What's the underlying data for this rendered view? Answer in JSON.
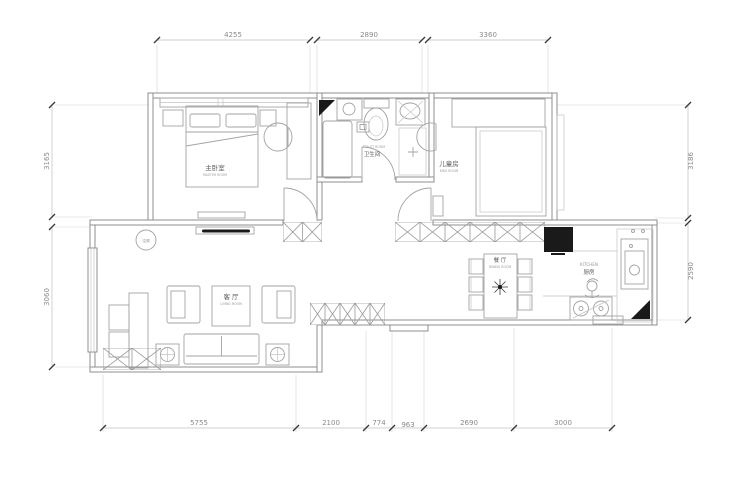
{
  "dims": {
    "top": [
      "4255",
      "2890",
      "3360"
    ],
    "bottom": [
      "5755",
      "2100",
      "774",
      "963",
      "2690",
      "3000"
    ],
    "left": [
      "3165",
      "3060"
    ],
    "right": [
      "3186",
      "2590"
    ]
  },
  "rooms": {
    "master": {
      "label": "主卧室",
      "sublabel": "MASTER ROOM"
    },
    "bathroom": {
      "label": "卫生间",
      "sublabel": "TOILET ROOM"
    },
    "kids": {
      "label": "儿童房",
      "sublabel": "KIDS ROOM"
    },
    "living": {
      "label": "客 厅",
      "sublabel": "LIVING ROOM"
    },
    "dining": {
      "label": "餐 厅",
      "sublabel": "DINING ROOM"
    },
    "kitchen": {
      "label": "KITCHEN",
      "sublabel": "厨房"
    }
  },
  "symbols": {
    "ac_marker": "空调"
  },
  "colors": {
    "background": "#ffffff",
    "wall_line": "#8f8f8f",
    "furniture_line": "#a3a3a3",
    "dimension_line": "#c0c0c0",
    "dimension_text": "#8a8a8a",
    "label_text": "#5a5a5a",
    "dark_fill": "#1a1a1a"
  }
}
